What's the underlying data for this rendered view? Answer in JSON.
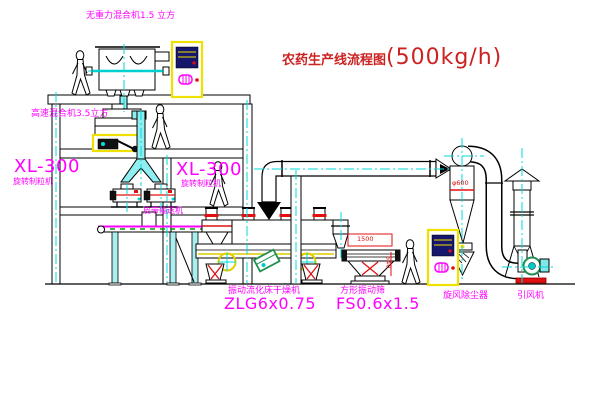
{
  "title": {
    "prefix": "农药生产线流程图",
    "capacity": "(500kg/h)"
  },
  "labels": {
    "gravity_mixer": "无重力混合机1.5 立方",
    "high_speed_mixer": "高速混合机3.5立方",
    "granulator_left_model": "XL-300",
    "granulator_left_name": "旋转制粒机",
    "granulator_right_model": "XL-300",
    "granulator_right_name": "旋转制粒机",
    "belt_conveyor": "皮带输送机",
    "dryer_name": "振动流化床干燥机",
    "dryer_model": "ZLG6x0.75",
    "screen_name": "方形振动筛",
    "screen_model": "FS0.6x1.5",
    "cyclone": "旋风除尘器",
    "fan": "引风机"
  },
  "dimensions": {
    "screen_length": "1500",
    "screen_height": "540",
    "cyclone_diameter": "φ600"
  },
  "colors": {
    "label_magenta": "#ff00ff",
    "title_red": "#cc2222",
    "dimension_red": "#e01010",
    "centerline_cyan": "#00d8d8",
    "pipe_cyan_fill": "#8feef0",
    "cabinet_yellow": "#f0e000",
    "motor_green": "#209050",
    "base_red": "#dd1111"
  }
}
